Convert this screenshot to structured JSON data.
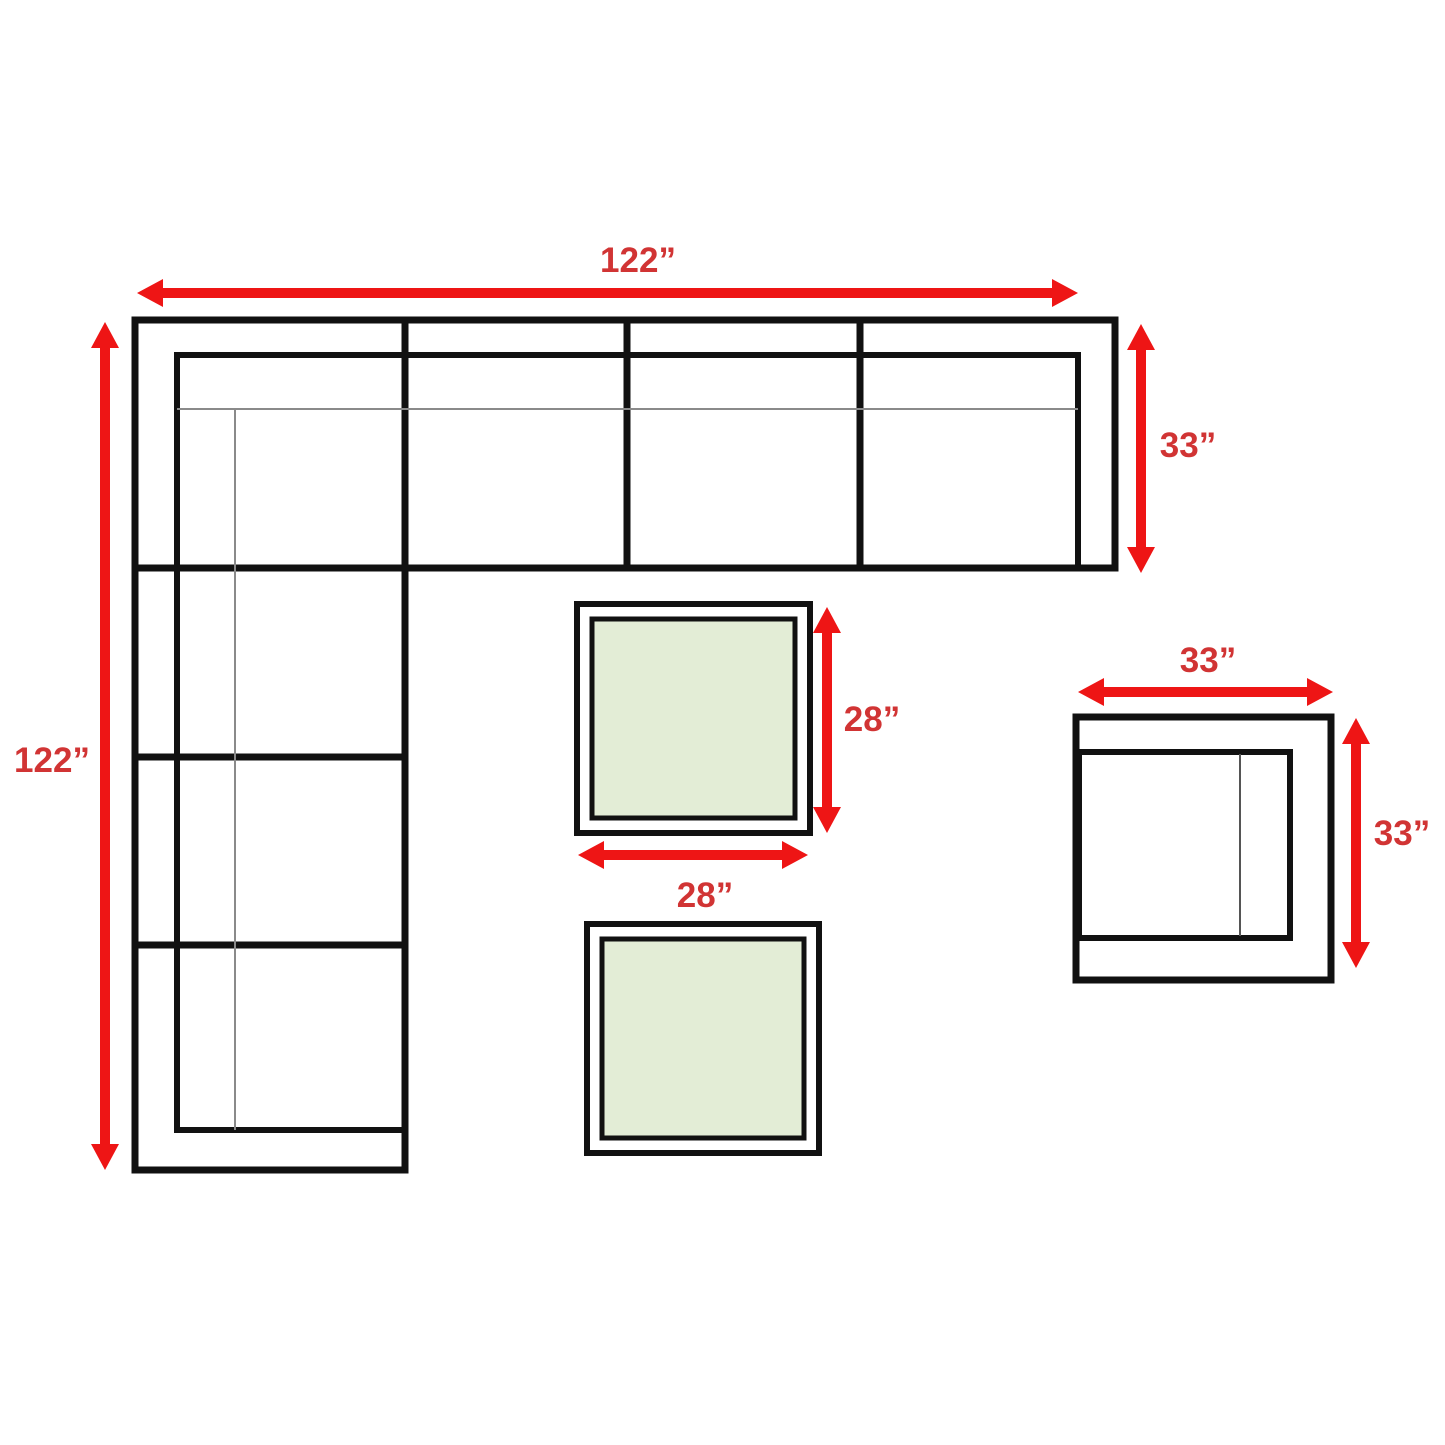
{
  "diagram": {
    "kind": "furniture-dimension-diagram",
    "items": {
      "sectional": {
        "name": "l-shaped-sectional-sofa",
        "width_label": "122”",
        "height_label": "122”",
        "depth_label": "33”"
      },
      "coffee_table_top": {
        "name": "square-coffee-table",
        "depth_label": "28”",
        "width_label": "28”"
      },
      "coffee_table_bottom": {
        "name": "square-coffee-table"
      },
      "chair": {
        "name": "club-chair",
        "width_label": "33”",
        "depth_label": "33”"
      }
    },
    "colors": {
      "arrow_red": "#ee1515",
      "label_red": "#d13434",
      "outline_black": "#111111",
      "detail_gray": "#8a8a8a",
      "cushion_gray": "#555555",
      "table_fill_green": "#e3edd6",
      "background": "#ffffff"
    }
  }
}
